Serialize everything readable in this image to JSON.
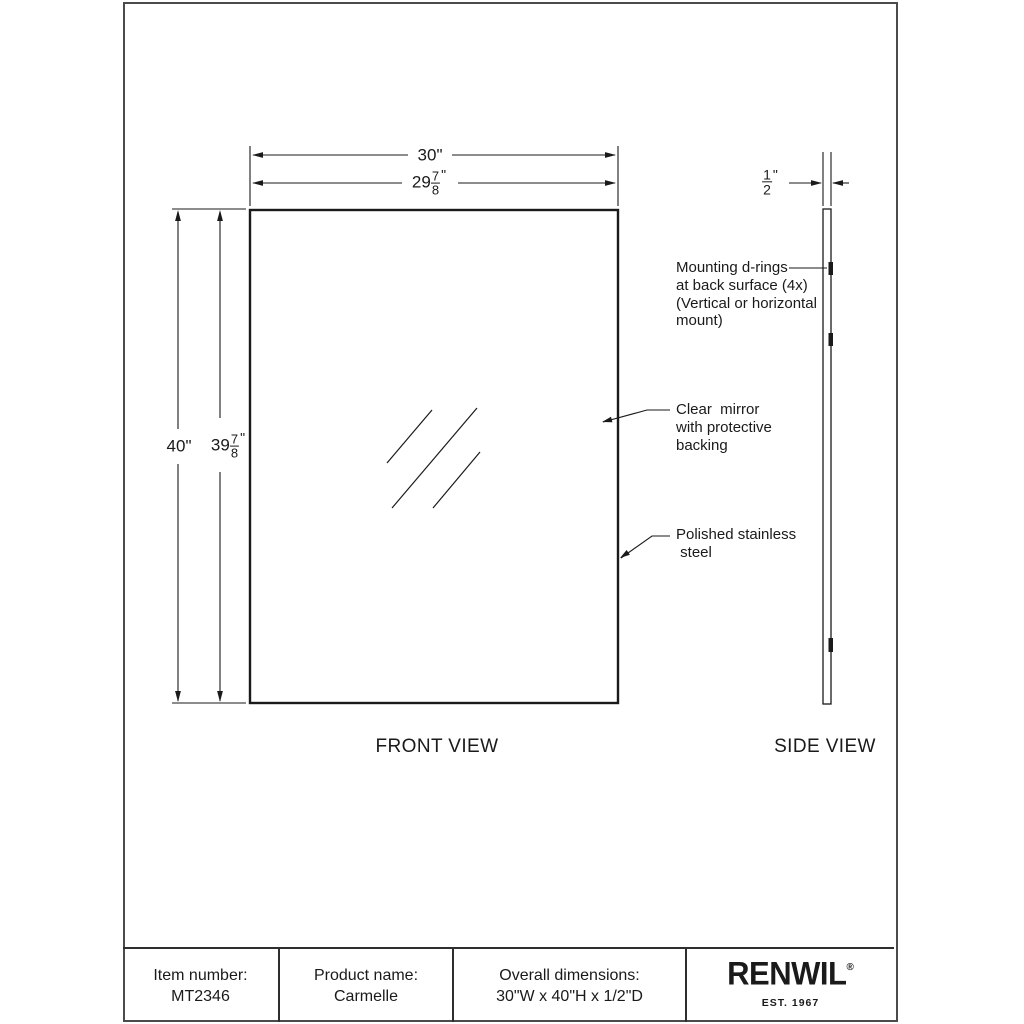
{
  "drawing": {
    "front_view": {
      "label": "FRONT VIEW",
      "dim_width_nominal": {
        "value": "30",
        "unit": "\""
      },
      "dim_width_actual": {
        "whole": "29",
        "num": "7",
        "den": "8",
        "unit": "\""
      },
      "dim_height_nominal": {
        "value": "40",
        "unit": "\""
      },
      "dim_height_actual": {
        "whole": "39",
        "num": "7",
        "den": "8",
        "unit": "\""
      }
    },
    "side_view": {
      "label": "SIDE VIEW",
      "dim_depth": {
        "num": "1",
        "den": "2",
        "unit": "\""
      }
    },
    "annotations": {
      "mounting": {
        "lines": [
          "Mounting d-rings",
          "at back surface (4x)",
          "(Vertical or horizontal",
          "mount)"
        ]
      },
      "mirror": {
        "lines": [
          "Clear  mirror",
          "with protective",
          "backing"
        ]
      },
      "frame": {
        "lines": [
          "Polished stainless",
          " steel"
        ]
      }
    }
  },
  "title_block": {
    "item_number_label": "Item number:",
    "item_number": "MT2346",
    "product_name_label": "Product name:",
    "product_name": "Carmelle",
    "dimensions_label": "Overall dimensions:",
    "dimensions": "30\"W x 40\"H x 1/2\"D",
    "brand": {
      "name": "RENWIL",
      "registered": "®",
      "tagline": "EST. 1967"
    }
  },
  "colors": {
    "line": "#1a1a1a",
    "border": "#4b4b4b",
    "background": "#ffffff"
  }
}
